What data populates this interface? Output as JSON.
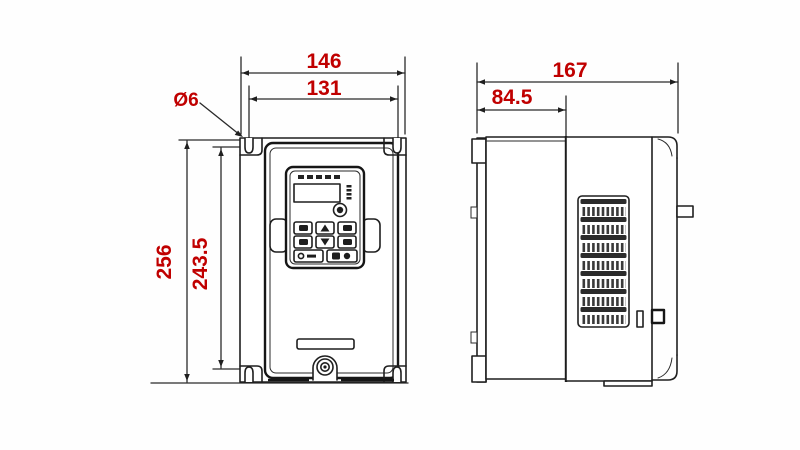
{
  "palette": {
    "dimension_color": "#c00000",
    "line_color": "#1f1f1f",
    "background": "#ffffff"
  },
  "front_view": {
    "dimensions": {
      "overall_width": "146",
      "mounting_hole_spacing_x": "131",
      "mounting_hole_diameter": "Ø6",
      "overall_height": "256",
      "mounting_hole_spacing_y": "243.5"
    }
  },
  "side_view": {
    "dimensions": {
      "overall_depth": "167",
      "front_section_depth": "84.5"
    }
  }
}
